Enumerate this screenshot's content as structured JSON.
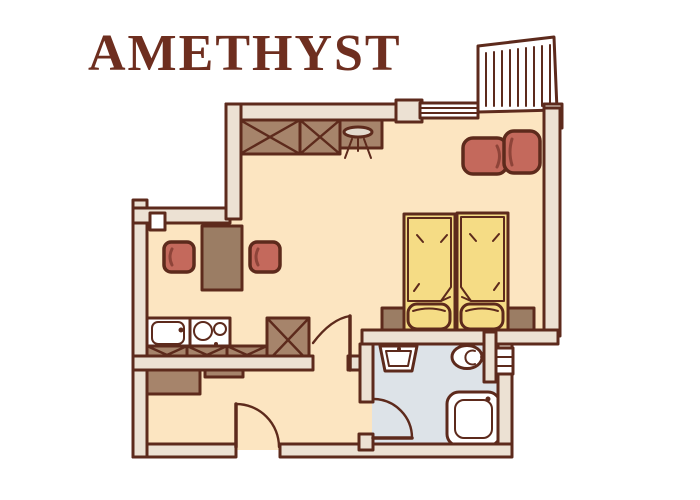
{
  "title": "AMETHYST",
  "colors": {
    "background": "#ffffff",
    "title-color": "#6e2e1f",
    "outline": "#5d2a1c",
    "wall": "#ece1d3",
    "floor": "#fce5c1",
    "bath-floor": "#dde3e8",
    "wood": "#a6846b",
    "wood-dark": "#9b7d64",
    "upholstery": "#c4695c",
    "bed-yellow": "#f5dc85",
    "fixture-white": "#ffffff",
    "stool-top": "#e3dace"
  },
  "plan_elements": {
    "rooms": [
      "living-sleeping-room",
      "kitchenette",
      "entrance-hall",
      "bathroom",
      "balcony"
    ],
    "furniture": [
      "wardrobe",
      "dressing-table-with-stool",
      "sofa",
      "dining-table-with-two-chairs",
      "two-single-beds-with-pillows",
      "headboard-bench",
      "kitchen-sink",
      "stove-two-burners",
      "crossed-cabinets",
      "washbasin",
      "toilet",
      "shower"
    ],
    "openings": [
      "entrance-door",
      "room-door",
      "bathroom-door",
      "balcony-window",
      "bathroom-window"
    ]
  }
}
